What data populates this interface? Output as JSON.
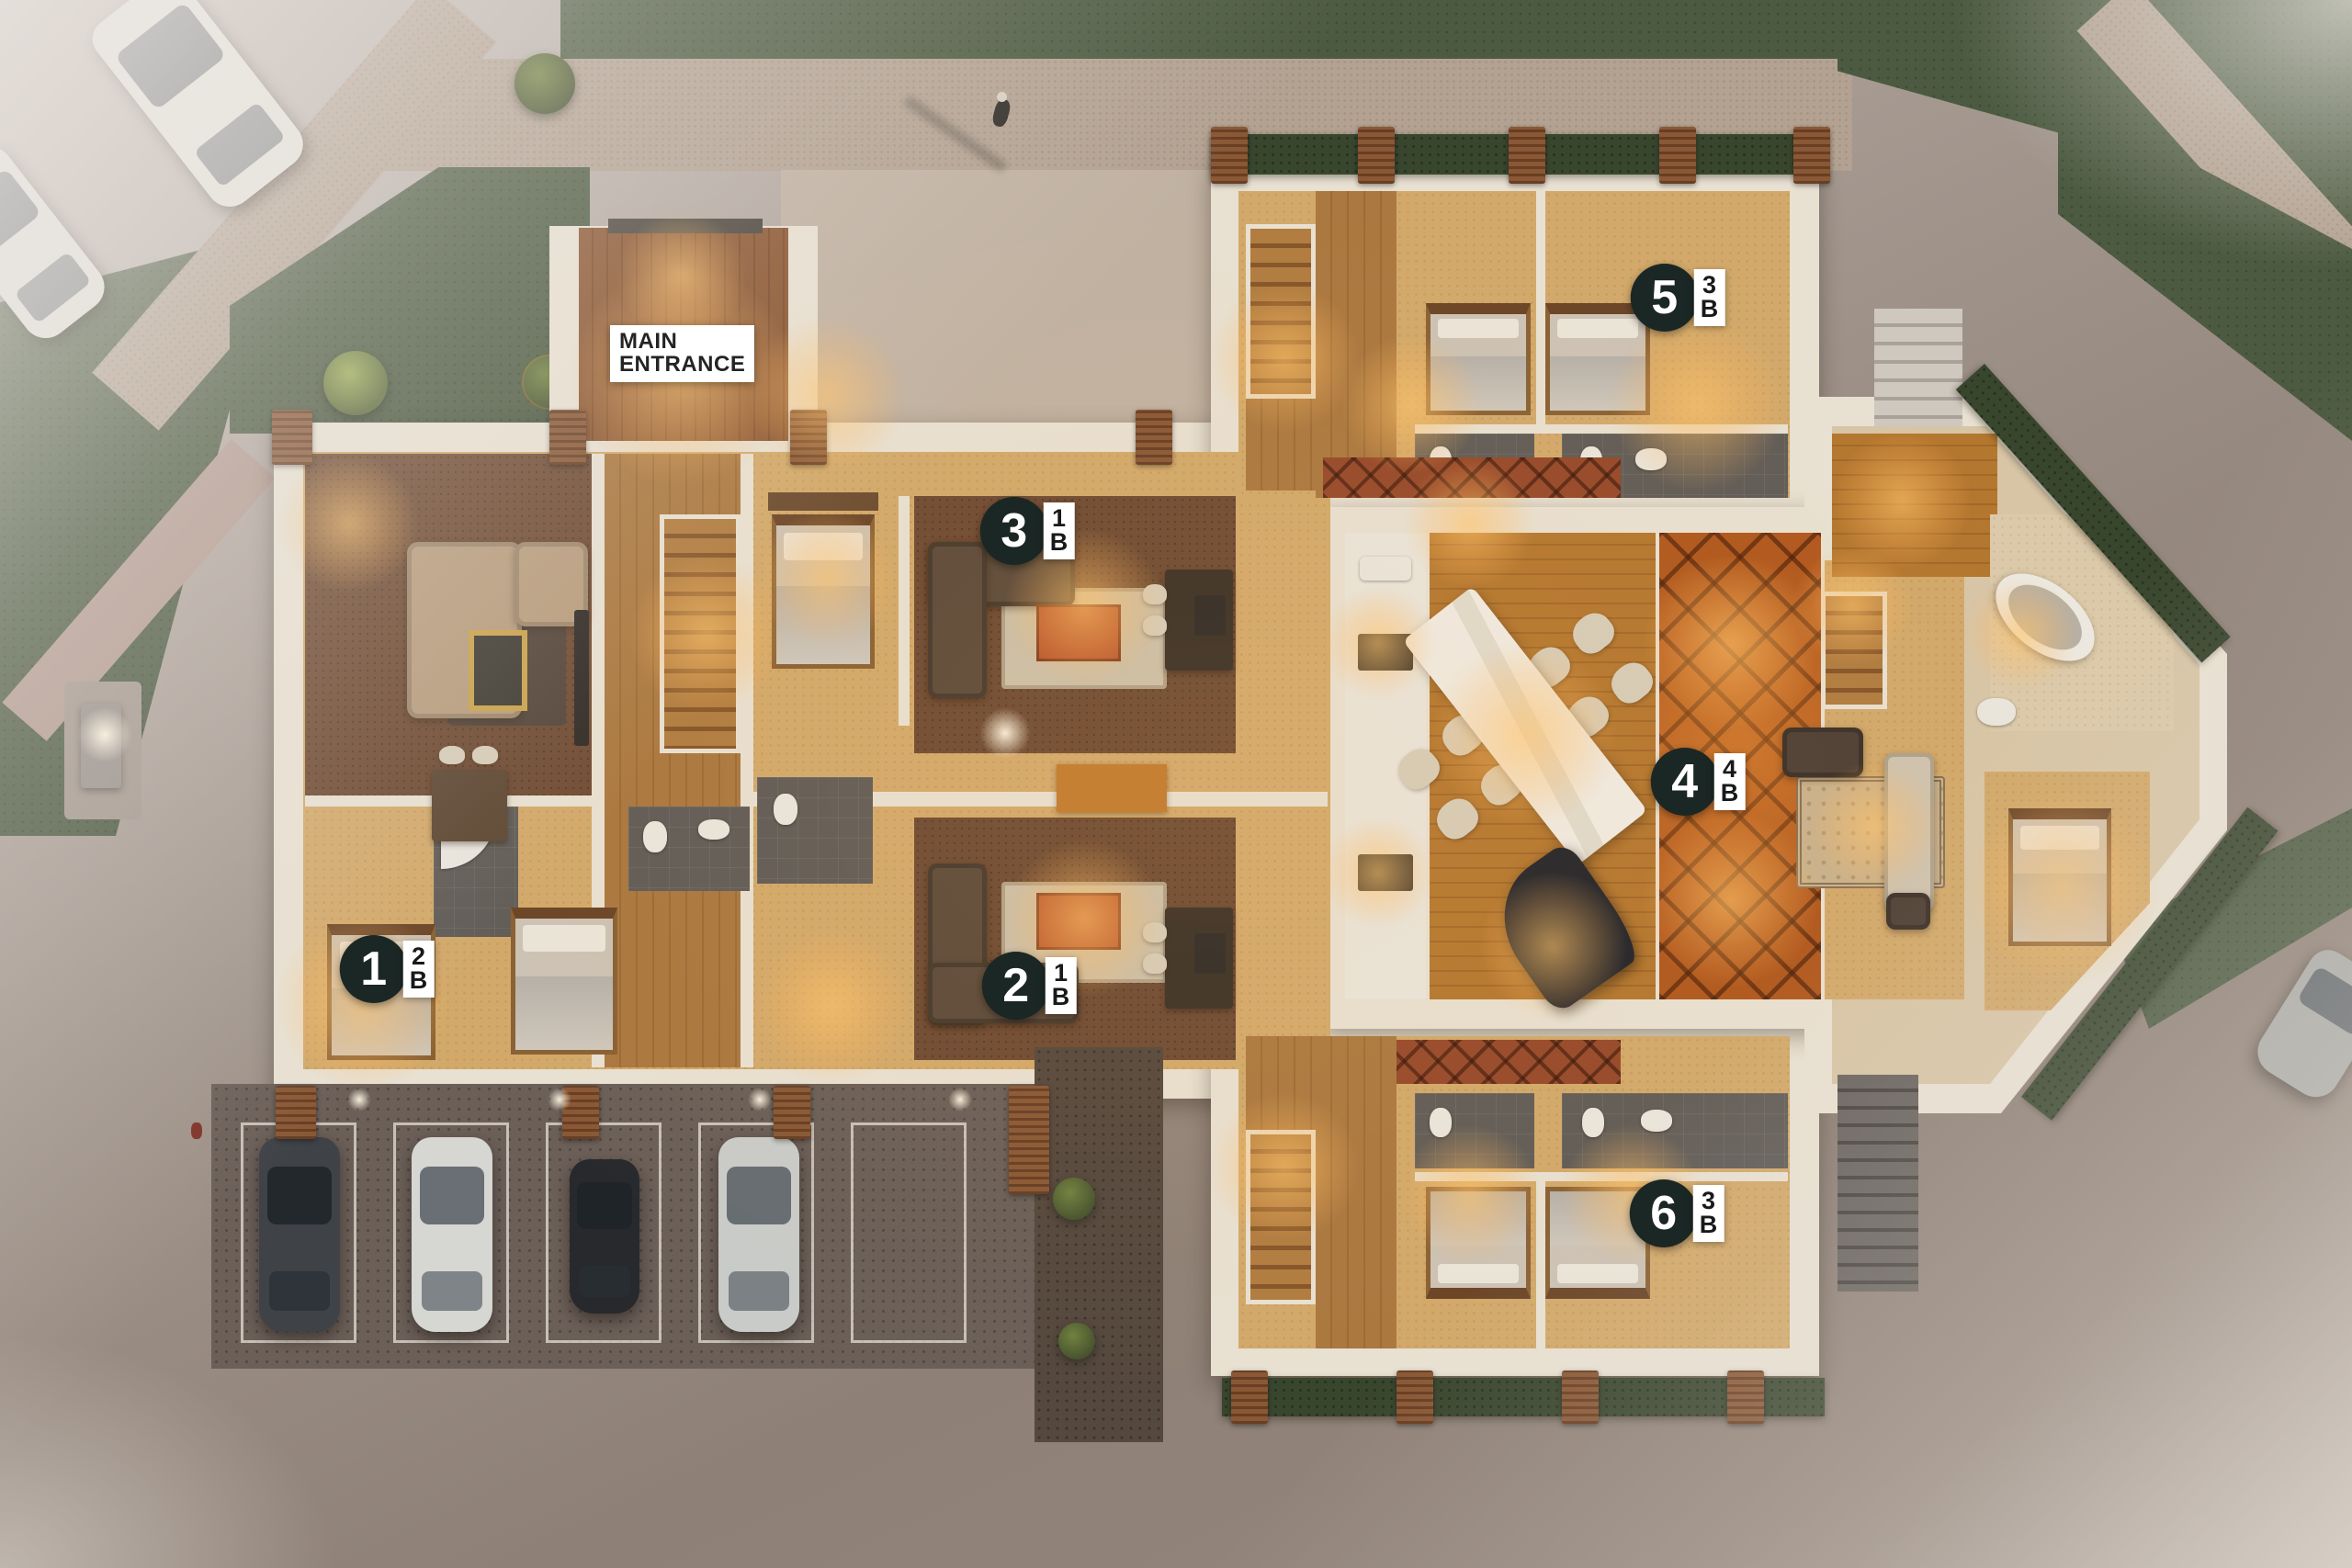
{
  "entrance": {
    "line1": "MAIN",
    "line2": "ENTRANCE"
  },
  "units": [
    {
      "number": "1",
      "beds": "2",
      "suffix": "B"
    },
    {
      "number": "2",
      "beds": "1",
      "suffix": "B"
    },
    {
      "number": "3",
      "beds": "1",
      "suffix": "B"
    },
    {
      "number": "4",
      "beds": "4",
      "suffix": "B"
    },
    {
      "number": "5",
      "beds": "3",
      "suffix": "B"
    },
    {
      "number": "6",
      "beds": "3",
      "suffix": "B"
    }
  ],
  "colors": {
    "badge_background": "#1b2724",
    "badge_text": "#ffffff",
    "tag_background": "#ffffff",
    "tag_text": "#17191b",
    "wall": "#e8e0d1",
    "lawn": "#4c5a41",
    "hedge": "#39462e",
    "orange_tile": "#b0581e",
    "wood_floor": "#aa7840",
    "warm_light": "#ffc369"
  }
}
